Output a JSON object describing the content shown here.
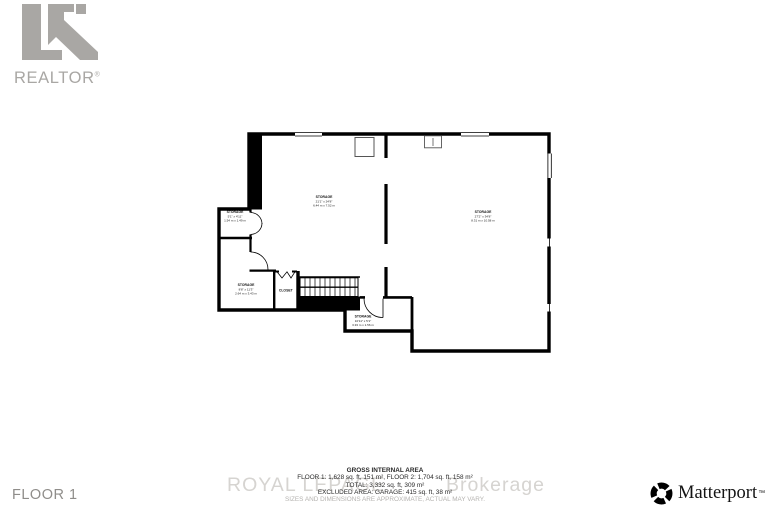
{
  "page": {
    "width": 767,
    "height": 511,
    "background": "#ffffff"
  },
  "header": {
    "realtor_logo_text": "REALTOR",
    "registered_mark": "®",
    "logo_color": "#a9a7a4"
  },
  "floorplan": {
    "wall_color": "#000000",
    "rooms": [
      {
        "id": "storage-main-left",
        "name": "STORAGE",
        "imperial": "21'1\" x 24'8\"",
        "metric": "6.44 m x 7.52 m"
      },
      {
        "id": "storage-main-right",
        "name": "STORAGE",
        "imperial": "27'2\" x 34'8\"",
        "metric": "8.31 m x 10.58 m"
      },
      {
        "id": "storage-small",
        "name": "STORAGE",
        "imperial": "5'1\" x 4'11\"",
        "metric": "1.54 m x 1.49 m"
      },
      {
        "id": "storage-left-lower",
        "name": "STORAGE",
        "imperial": "8'8\" x 11'3\"",
        "metric": "2.64 m x 3.43 m"
      },
      {
        "id": "closet",
        "name": "CLOSET",
        "imperial": "",
        "metric": ""
      },
      {
        "id": "storage-bottom",
        "name": "STORAGE",
        "imperial": "10'11\" x 5'1\"",
        "metric": "3.33 m x 1.56 m"
      }
    ]
  },
  "area_summary": {
    "title": "GROSS INTERNAL AREA",
    "floors_line": "FLOOR 1: 1,628 sq. ft, 151 m², FLOOR 2: 1,704 sq. ft, 158 m²",
    "total_line": "TOTAL: 3,332 sq. ft, 309 m²",
    "excluded_line": "EXCLUDED AREA: GARAGE: 415 sq. ft, 38 m²",
    "disclaimer": "SIZES AND DIMENSIONS ARE APPROXIMATE, ACTUAL MAY VARY."
  },
  "watermark": {
    "left": "ROYAL LEPAGE",
    "right": "Brokerage"
  },
  "footer": {
    "floor_label": "FLOOR 1",
    "matterport_label": "Matterport",
    "matterport_mark": "™"
  }
}
